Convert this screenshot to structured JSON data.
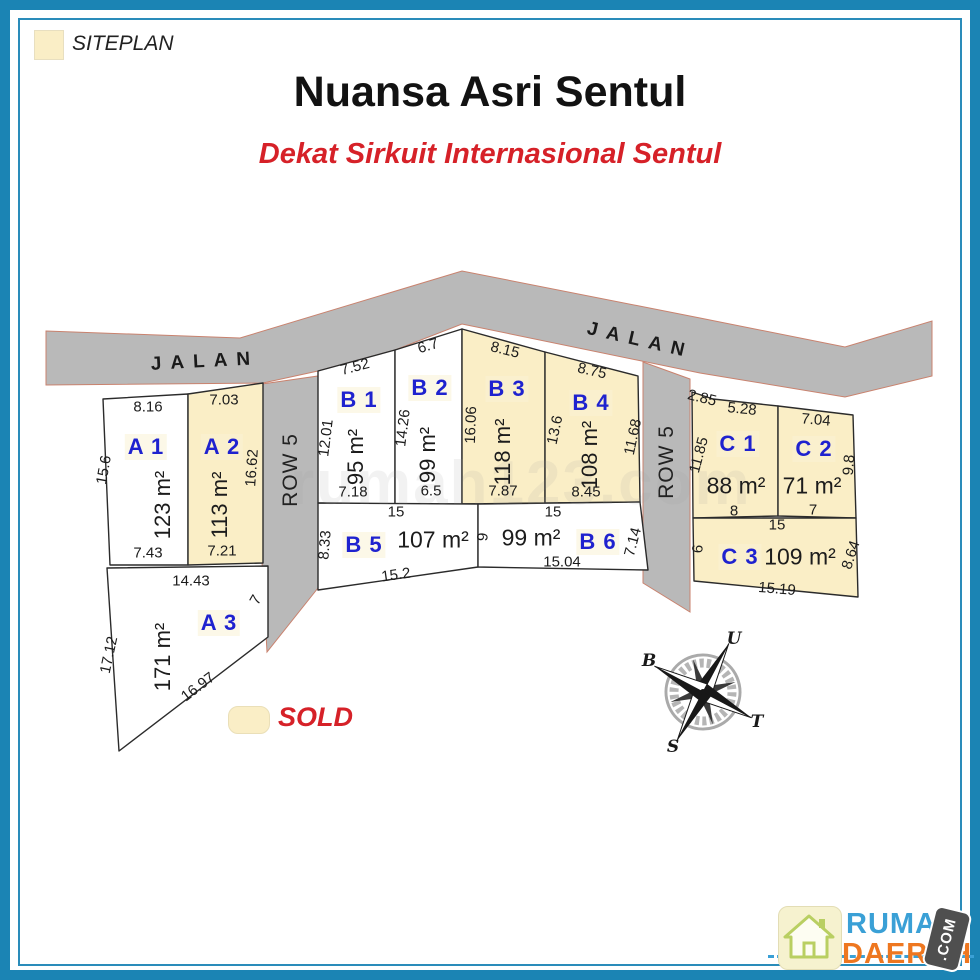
{
  "header": {
    "title": "Nuansa Asri Sentul",
    "subtitle": "Dekat Sirkuit Internasional Sentul"
  },
  "legend": {
    "siteplan": "SITEPLAN",
    "sold": "SOLD"
  },
  "roads": {
    "jalan": "JALAN",
    "row": "ROW 5"
  },
  "compass": {
    "n": "U",
    "e": "T",
    "s": "S",
    "w": "B"
  },
  "watermark": "rumah123.com",
  "logo": {
    "name_top": "RUMAH",
    "name_bottom": "DAERAH",
    "badge": ".COM"
  },
  "colors": {
    "border_blue": "#1b84b4",
    "sold_fill": "#faeec6",
    "road_gray": "#b9b9b9",
    "road_edge": "#c9826e",
    "lot_id_blue": "#1f22cf",
    "accent_red": "#d62128",
    "logo_blue": "#3aa0d6",
    "logo_orange": "#ee7720"
  },
  "lots": {
    "a1": {
      "id": "A 1",
      "area": "123 m²",
      "sold": false,
      "top": "8.16",
      "left": "15.6",
      "bottom": "7.43"
    },
    "a2": {
      "id": "A 2",
      "area": "113 m²",
      "sold": true,
      "top": "7.03",
      "right": "16.62",
      "bottom": "7.21"
    },
    "a3": {
      "id": "A 3",
      "area": "171 m²",
      "sold": false,
      "top": "14.43",
      "left": "17.12",
      "right": "7",
      "diagonal": "16.97"
    },
    "b1": {
      "id": "B 1",
      "area": "95 m²",
      "sold": false,
      "top": "7.52",
      "left": "12.01",
      "bottom": "7.18"
    },
    "b2": {
      "id": "B 2",
      "area": "99 m²",
      "sold": false,
      "top": "6.7",
      "left": "14.26",
      "bottom": "6.5"
    },
    "b3": {
      "id": "B 3",
      "area": "118 m²",
      "sold": true,
      "top": "8.15",
      "left": "16.06",
      "bottom": "7.87"
    },
    "b4": {
      "id": "B 4",
      "area": "108 m²",
      "sold": true,
      "top": "8.75",
      "left": "13.6",
      "right": "11.68",
      "bottom": "8.45"
    },
    "b5": {
      "id": "B 5",
      "area": "107 m²",
      "sold": false,
      "top": "15",
      "left": "8.33",
      "bottom": "15.2"
    },
    "b6": {
      "id": "B 6",
      "area": "99 m²",
      "sold": false,
      "top": "15",
      "left": "9",
      "right": "7.14",
      "bottom": "15.04"
    },
    "c1": {
      "id": "C 1",
      "area": "88 m²",
      "sold": true,
      "corner": "2.85",
      "top": "5.28",
      "left": "11.85",
      "bottom": "8"
    },
    "c2": {
      "id": "C 2",
      "area": "71 m²",
      "sold": true,
      "top": "7.04",
      "right": "9.8",
      "bottom": "7"
    },
    "c3": {
      "id": "C 3",
      "area": "109 m²",
      "sold": true,
      "top": "15",
      "left": "6",
      "right": "8.64",
      "bottom": "15.19"
    }
  }
}
